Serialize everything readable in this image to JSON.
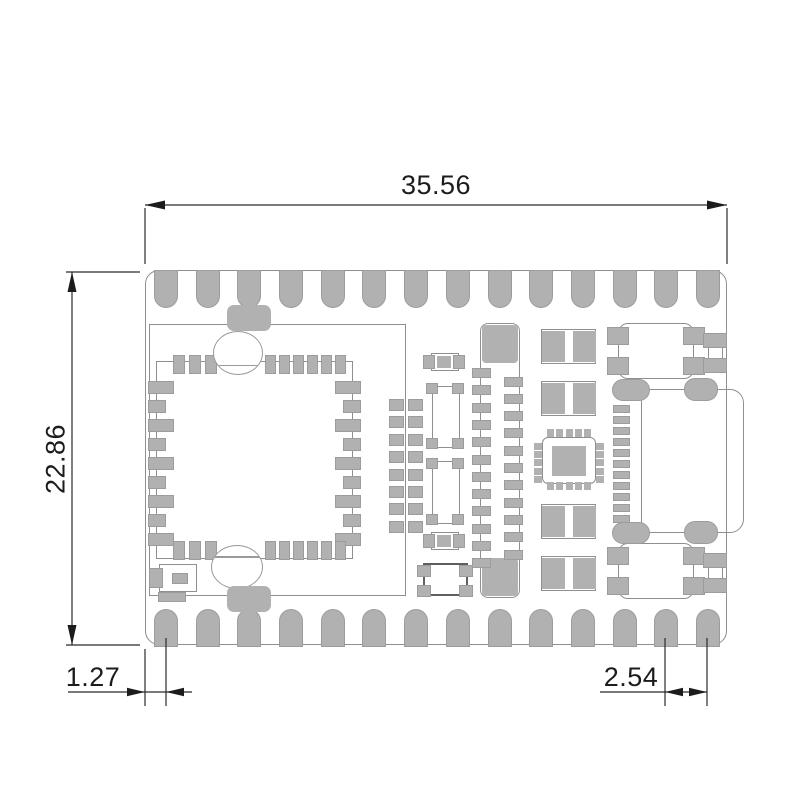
{
  "drawing": {
    "title": "PCB castellated module - mechanical dimension drawing",
    "units_shown": "mm"
  },
  "dimensions": {
    "width": "35.56",
    "height": "22.86",
    "edge_to_first_pin": "1.27",
    "pin_pitch": "2.54"
  },
  "board": {
    "castellated_pads_top": 14,
    "castellated_pads_bottom": 14,
    "main_qfn_side_pads": 9,
    "main_qfn_top_group_a": 3,
    "main_qfn_top_group_b": 6,
    "pad_array_rows": 8,
    "header_pins_left": 12,
    "header_pins_right": 11,
    "usb_pin_count": 11,
    "small_qfn_pads_per_side": 5,
    "two_pad_components_right": 4,
    "button_footprints": 2
  },
  "colors": {
    "pad": "#b1b1b1",
    "pad_border": "#9c9c9c",
    "outline": "#8f8f8f",
    "dimension": "#1c1c1c",
    "background": "#ffffff"
  }
}
